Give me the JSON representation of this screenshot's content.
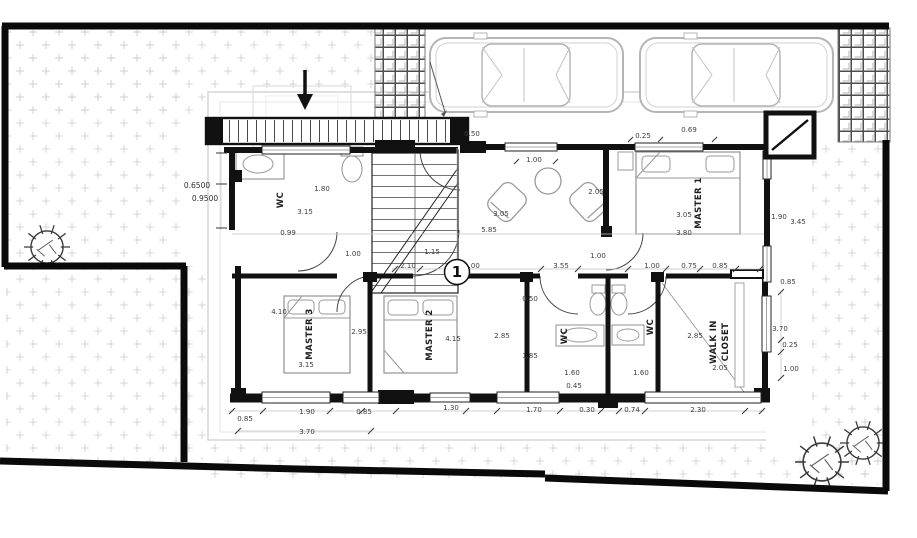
{
  "plan": {
    "bubble": "1",
    "rooms": {
      "wc_top": "WC",
      "master1": "MASTER 1",
      "master3": "MASTER 3",
      "master2": "MASTER 2",
      "wc_left": "WC",
      "wc_right": "WC",
      "wic_line1": "WALK IN",
      "wic_line2": "CLOSET"
    },
    "dims": {
      "top": {
        "a": "0.50",
        "b": "0.25",
        "c": "0.69",
        "d": "1.00"
      },
      "left": {
        "a": "0.6500",
        "b": "0.9500"
      },
      "wcTop": {
        "a": "1.80",
        "b": "3.15",
        "c": "0.99"
      },
      "hall": {
        "a": "1.00",
        "b": "1.15",
        "c": "3.05",
        "d": "2.05",
        "e": "5.85",
        "f": "1.00"
      },
      "row": {
        "a": "2.10",
        "b": "1.00",
        "c": "3.55",
        "d": "1.00",
        "e": "0.75",
        "f": "0.85"
      },
      "m1": {
        "a": "3.05",
        "b": "3.80"
      },
      "right": {
        "a": "1.90",
        "b": "3.45",
        "c": "0.85",
        "d": "3.70",
        "e": "0.25",
        "f": "1.00"
      },
      "m3": {
        "a": "4.10",
        "b": "2.95",
        "c": "3.15"
      },
      "m2": {
        "a": "4.15"
      },
      "bath": {
        "a": "0.50",
        "b": "2.85",
        "c": "1.85"
      },
      "wcBot": {
        "a": "1.60",
        "b": "0.45",
        "c": "1.60"
      },
      "closet": {
        "a": "2.85",
        "b": "2.05"
      },
      "bottom": {
        "a": "0.85",
        "b": "1.90",
        "c": "0.85",
        "d": "1.30",
        "e": "1.70",
        "f": "0.30",
        "g": "0.74",
        "h": "2.30",
        "i": "3.70"
      }
    },
    "colors": {
      "wall": "#111111",
      "site_boundary": "#0a0a0a",
      "furniture": "#9a9a9a",
      "dim_text": "#3d3d3d",
      "grass_dot": "#c9c9c9",
      "paving": "#555555",
      "roof_outline": "#d6d6d6"
    }
  }
}
